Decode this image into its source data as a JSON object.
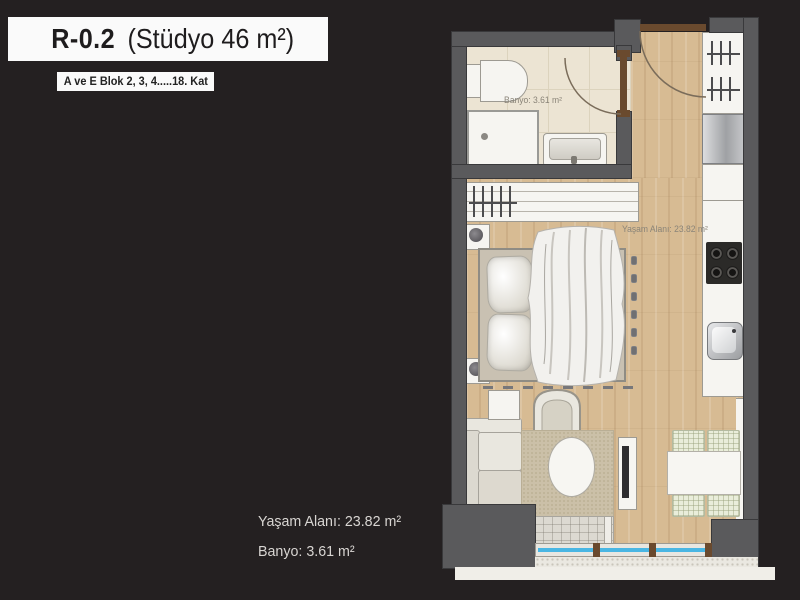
{
  "header": {
    "title_code": "R-0.2",
    "title_detail": "(Stüdyo 46 m²)",
    "subtitle": "A ve E Blok 2, 3, 4.....18. Kat"
  },
  "summary": {
    "living_area": "Yaşam Alanı: 23.82 m²",
    "bathroom_area": "Banyo: 3.61 m²"
  },
  "plan": {
    "bathroom_label": "Banyo: 3.61 m²",
    "living_label": "Yaşam Alanı: 23.82 m²",
    "unit_type": "Stüdyo",
    "total_area_m2": "46",
    "living_area_m2": "23.82",
    "bathroom_area_m2": "3.61"
  },
  "colors": {
    "background": "#242021",
    "wall_gray": "#5a5a5c",
    "wood_floor": "#d7bb93",
    "bath_tile": "#ece4d3",
    "window_glass": "#49b6e3",
    "door_wood": "#6a4a2e",
    "rug": "#cbc0a8",
    "label_text": "#8a8478"
  }
}
